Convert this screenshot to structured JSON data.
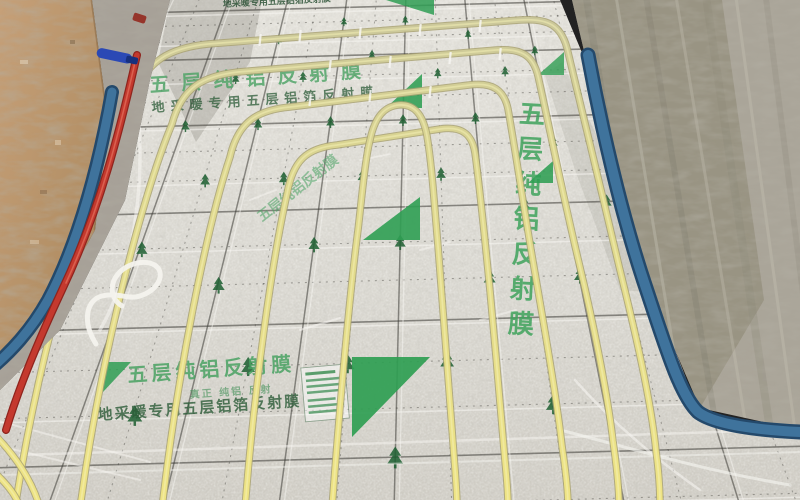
{
  "film_print": {
    "title": "五层纯铝反射膜",
    "subtitle": "地采暖专用五层铝箔反射膜",
    "tagline": "真正 纯铝 反射",
    "vertical_title": "五层纯铝反射膜"
  },
  "colors": {
    "film_base": "#d9d7d0",
    "film_shadow": "#8d897f",
    "grid_line": "#3c3b36",
    "mesh_white": "#f7f6f2",
    "pipe_yellow": "#e9e187",
    "pipe_pale": "#c9c69c",
    "pipe_edge": "#a9a272",
    "logo_green": "#2f9e53",
    "tree_green": "#1d5f31",
    "text_green": "#4aa263",
    "text_dark_green": "#2c5c38",
    "wall_left_tan": "#be9a72",
    "wall_right_gray": "#aaa599",
    "wall_right_dark": "#96917f",
    "edge_strip_blue": "#3f739c",
    "edge_strip_dark": "#24496b",
    "red_pipe": "#c4392e",
    "tool_blue": "#2b49b5",
    "concrete_gray": "#a7a198"
  }
}
